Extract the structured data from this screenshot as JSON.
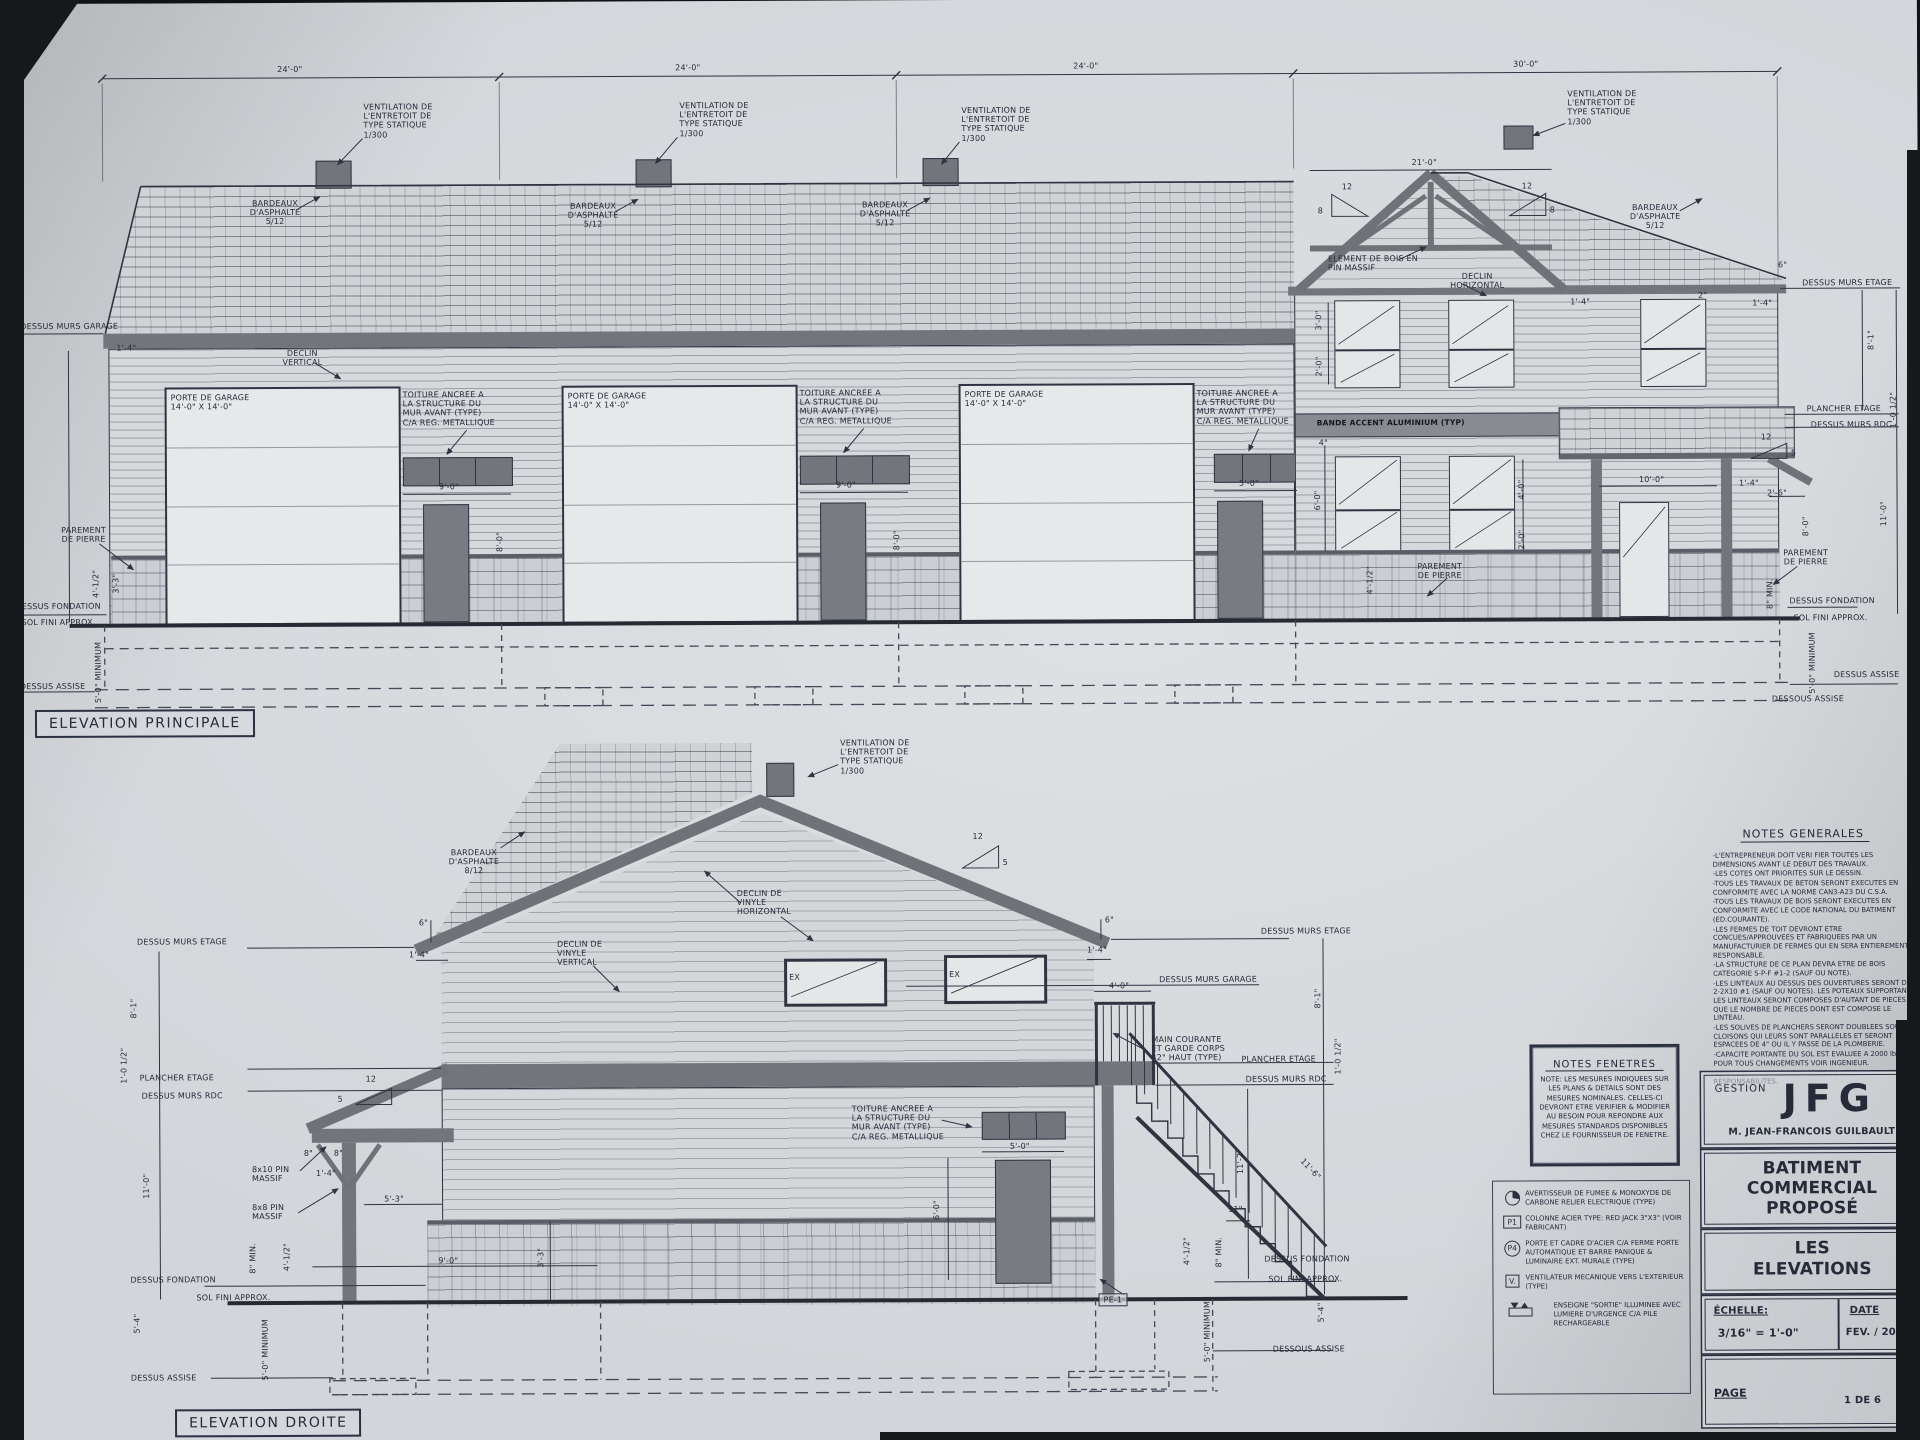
{
  "titles": {
    "principale": "ELEVATION PRINCIPALE",
    "droite": "ELEVATION DROITE"
  },
  "shared": {
    "vent_note": "VENTILATION DE\nL'ENTRETOIT DE\nTYPE STATIQUE\n1/300",
    "bardeaux_5": "BARDEAUX\nD'ASPHALTE\n5/12",
    "bardeaux_8": "BARDEAUX\nD'ASPHALTE\n8/12",
    "toiture_ancree": "TOITURE ANCREE A\nLA STRUCTURE DU\nMUR AVANT (TYPE)\nC/A REG. METALLIQUE",
    "porte_garage": "PORTE DE GARAGE\n14'-0\" X 14'-0\"",
    "declin_vertical": "DECLIN\nVERTICAL",
    "declin_horizontal": "DECLIN\nHORIZONTAL",
    "declin_vinyle_h": "DECLIN DE\nVINYLE\nHORIZONTAL",
    "declin_vinyle_v": "DECLIN DE\nVINYLE\nVERTICAL",
    "parement": "PAREMENT\nDE PIERRE",
    "element_bois": "ELEMENT DE BOIS EN\nPIN MASSIF",
    "bande_accent": "BANDE ACCENT ALUMINIUM (TYP)",
    "main_courante": "MAIN COURANTE\nET GARDE CORPS\n42\" HAUT (TYPE)",
    "dessus_murs_garage": "DESSUS MURS GARAGE",
    "dessus_murs_etage": "DESSUS MURS ETAGE",
    "dessus_murs_rdc": "DESSUS MURS RDC",
    "plancher_etage": "PLANCHER ETAGE",
    "dessus_fondation": "DESSUS FONDATION",
    "sol_fini": "SOL FINI APPROX.",
    "dessus_assise": "DESSUS ASSISE",
    "dessous_assise": "DESSOUS ASSISE",
    "min_5": "5'-0\" MINIMUM",
    "min_8": "8\" MIN.",
    "pin_8x10": "8x10 PIN\nMASSIF",
    "pin_8x8": "8x8 PIN\nMASSIF",
    "ex": "EX",
    "pe1": "PE-1"
  },
  "dims": {
    "d24": "24'-0\"",
    "d30": "30'-0\"",
    "d21": "21'-0\"",
    "d9": "9'-0\"",
    "d10": "10'-0\"",
    "d5_0": "5'-0\"",
    "d5_3": "5'-3\"",
    "d8": "8'-0\"",
    "d8_1": "8'-1\"",
    "d8_4": "8'-4\"",
    "d17_2": "17'-2\"",
    "d11": "11'-0\"",
    "d11_2": "11'-2\"",
    "d11_6": "11'-6\"",
    "d11in": "11\"",
    "d1_4": "1'-4\"",
    "d6in": "6\"",
    "d2in": "2\"",
    "d4in": "4\"",
    "d8in": "8\"",
    "d3_0": "3'-0\"",
    "d2_0": "2'-0\"",
    "d4_0": "4'-0\"",
    "d6_0": "6'-0\"",
    "d2_6": "2'-6\"",
    "d3_3": "3'-3\"",
    "d5_4": "5'-4\"",
    "d4_05": "4'-1/2\"",
    "d1_0h": "1'-0 1/2\"",
    "s12": "12",
    "s8": "8",
    "s5": "5"
  },
  "notes_generales": {
    "heading": "NOTES GENERALES",
    "lines": [
      "-L'ENTREPRENEUR DOIT VERI FIER TOUTES LES DIMENSIONS AVANT LE DEBUT DES TRAVAUX.",
      "-LES COTES ONT PRIORITES SUR LE DESSIN.",
      "-TOUS LES TRAVAUX DE BETON SERONT EXECUTES EN CONFORMITE AVEC LA NORME CAN3-A23 DU C.S.A.",
      "-TOUS LES TRAVAUX DE BOIS SERONT EXECUTES EN CONFORMITE AVEC LE CODE NATIONAL DU BATIMENT (ED.COURANTE).",
      "-LES FERMES DE TOIT DEVRONT ETRE CONCUES/APPROUVEES ET FABRIQUEES PAR UN MANUFACTURIER DE FERMES QUI EN SERA ENTIEREMENT RESPONSABLE.",
      "-LA STRUCTURE DE CE PLAN DEVRA ETRE DE BOIS CATEGORIE S-P-F #1-2 (SAUF OU NOTE).",
      "-LES LINTEAUX AU DESSUS DES OUVERTURES SERONT DE 2-2X10 #1 (SAUF OU NOTES). LES POTEAUX SUPPORTANT LES LINTEAUX SERONT COMPOSES D'AUTANT DE PIECES QUE LE NOMBRE DE PIECES DONT EST COMPOSE LE LINTEAU.",
      "-LES SOLIVES DE PLANCHERS SERONT DOUBLEES SOUS LES CLOISONS QUI LEURS SONT PARALLELES ET SERONT ESPACEES DE 4\" OU IL Y PASSE DE LA PLOMBERIE.",
      "-CAPACITE PORTANTE DU SOL EST EVALUEE A 2000 lbs/pi2. POUR TOUS CHANGEMENTS VOIR INGENIEUR.",
      "-LE DESSINATEUR SE DEGAGE DE TOUTES RESPONSABILITES."
    ]
  },
  "notes_fenetres": {
    "heading": "NOTES FENETRES",
    "body": "NOTE: LES MESURES INDIQUEES SUR LES PLANS & DETAILS SONT DES MESURES NOMINALES. CELLES-CI DEVRONT ETRE VERIFIER & MODIFIER AU BESOIN POUR REPONDRE AUX MESURES STANDARDS DISPONIBLES CHEZ LE FOURNISSEUR DE FENETRE."
  },
  "legend": {
    "items": [
      {
        "tag": "",
        "text": "AVERTISSEUR DE FUMEE & MONOXYDE DE CARBONE RELIER ELECTRIQUE (TYPE)"
      },
      {
        "tag": "P1",
        "text": "COLONNE ACIER TYPE: RED JACK 3\"X3\" (VOIR FABRICANT)"
      },
      {
        "tag": "P4",
        "text": "PORTE ET CADRE D'ACIER C/A FERME PORTE AUTOMATIQUE ET BARRE PANIQUE & LUMINAIRE EXT. MURALE (TYPE)"
      },
      {
        "tag": "V.",
        "text": "VENTILATEUR MECANIQUE VERS L'EXTERIEUR (TYPE)"
      },
      {
        "tag": "",
        "text": "ENSEIGNE \"SORTIE\" ILLUMINEE AVEC LUMIERE D'URGENCE C/A PILE RECHARGEABLE"
      }
    ]
  },
  "title_block": {
    "gestion": "GESTION",
    "logo": "JFG",
    "client": "M. JEAN-FRANCOIS GUILBAULT",
    "project": "BATIMENT\nCOMMERCIAL\nPROPOSÉ",
    "sheet_title": "LES\nELEVATIONS",
    "scale_label": "ÉCHELLE:",
    "scale_value": "3/16\" = 1'-0\"",
    "date_label": "DATE",
    "date_value": "FEV. / 2025",
    "page_label": "PAGE",
    "page_value": "1 DE 6"
  }
}
